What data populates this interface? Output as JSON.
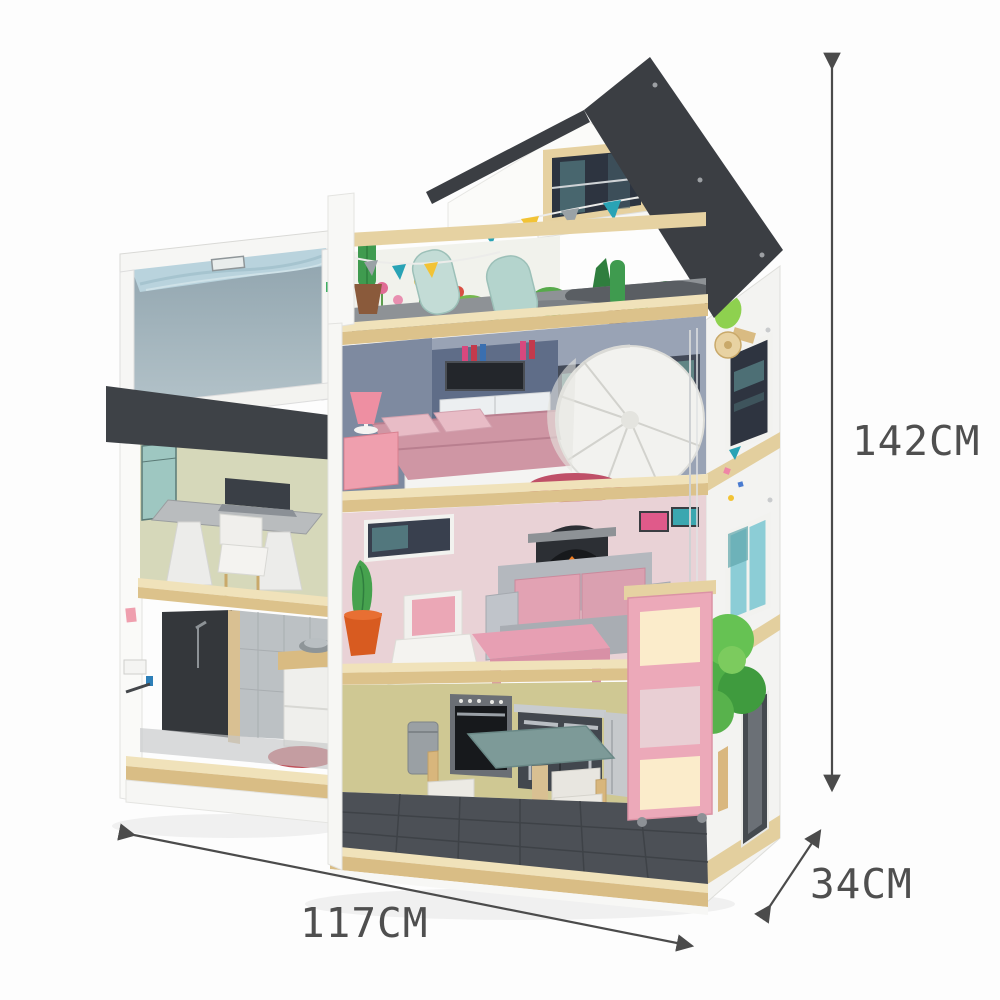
{
  "product": {
    "name": "wooden dollhouse",
    "annotations": {
      "height": {
        "label": "142CM"
      },
      "width": {
        "label": "117CM"
      },
      "depth": {
        "label": "34CM"
      }
    }
  },
  "palette": {
    "annotation_text": "#4f4f4f",
    "arrow": "#4b4b4b",
    "roof": "#3b3e43",
    "wood_trim": "#ead8a8",
    "pool_water": "#b9d3dd",
    "awning": "#3e4247",
    "office_wall": "#d6d8ba",
    "bedroom_wall": "#99a3b5",
    "living_wall": "#e9d2d6",
    "kitchen_wall": "#cfc893",
    "kitchen_floor": "#4c5056",
    "accent_pink": "#eca9b9",
    "table_teal": "#7d9a98"
  }
}
